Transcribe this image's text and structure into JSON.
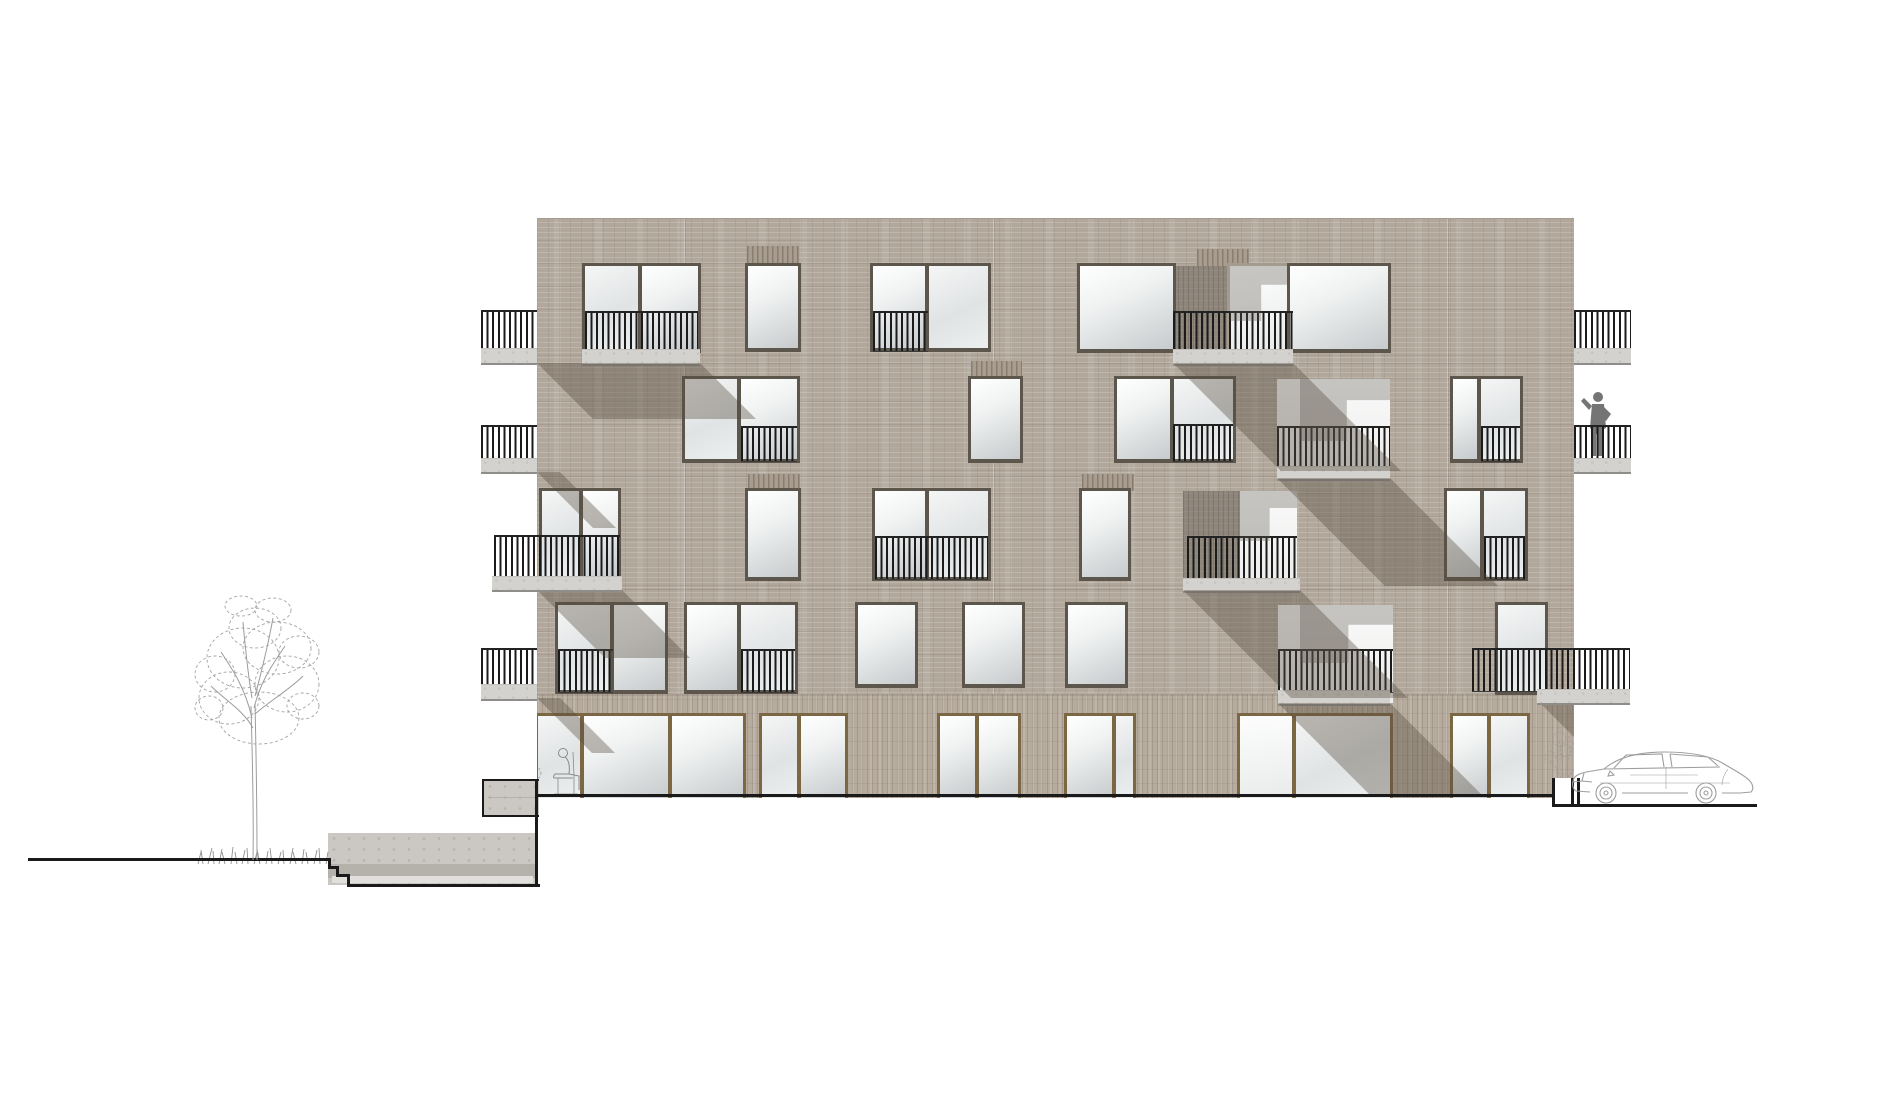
{
  "canvas": {
    "w": 1900,
    "h": 1116,
    "bg": "#ffffff"
  },
  "colors": {
    "brick": "#b1a79b",
    "brickGround": "#b6ab9d",
    "brickDark": "#8e857b",
    "concrete": "#d4d2ce",
    "railing": "#1b1b1b",
    "frameDark": "#5d564d",
    "frameBrown": "#7c6745",
    "shadow": "rgba(86,76,64,0.38)",
    "cut": "#1a1a1a",
    "sketch": "#9c9c9c",
    "figure": "#757575"
  },
  "building": {
    "x": 537,
    "y": 218,
    "w": 1037,
    "h": 579,
    "groundBandY": 693,
    "groundBandH": 104
  },
  "floorLines": [
    362,
    475,
    588
  ],
  "joints": [
    684,
    993,
    1447
  ],
  "levels": {
    "l5": {
      "y": 265,
      "h": 83
    },
    "l4": {
      "y": 378,
      "h": 80
    },
    "l3": {
      "y": 490,
      "h": 86
    },
    "l2": {
      "y": 604,
      "h": 85
    },
    "l1": {
      "y": 715,
      "h": 82
    }
  },
  "windows": [
    {
      "x": 585,
      "y": 265,
      "w": 113,
      "h": 83,
      "f": "d",
      "panes": [
        [
          0,
          53,
          "g2"
        ],
        [
          57,
          56,
          "g1"
        ]
      ]
    },
    {
      "x": 748,
      "y": 265,
      "w": 50,
      "h": 82,
      "f": "d",
      "panes": [
        [
          0,
          50,
          "g1"
        ]
      ]
    },
    {
      "x": 873,
      "y": 265,
      "w": 115,
      "h": 82,
      "f": "d",
      "panes": [
        [
          0,
          52,
          "g1"
        ],
        [
          56,
          59,
          "g2"
        ]
      ]
    },
    {
      "x": 1080,
      "y": 265,
      "w": 93,
      "h": 83,
      "f": "d",
      "panes": [
        [
          0,
          93,
          "g1"
        ]
      ]
    },
    {
      "x": 1230,
      "y": 265,
      "w": 60,
      "h": 83,
      "f": "l",
      "panes": [
        [
          0,
          60,
          "g3"
        ]
      ]
    },
    {
      "x": 1290,
      "y": 265,
      "w": 98,
      "h": 83,
      "f": "d",
      "panes": [
        [
          0,
          98,
          "g1"
        ]
      ]
    },
    {
      "x": 685,
      "y": 378,
      "w": 112,
      "h": 80,
      "f": "d",
      "panes": [
        [
          0,
          52,
          "g2"
        ],
        [
          56,
          56,
          "g1"
        ]
      ]
    },
    {
      "x": 971,
      "y": 378,
      "w": 49,
      "h": 80,
      "f": "d",
      "panes": [
        [
          0,
          49,
          "g1"
        ]
      ]
    },
    {
      "x": 1117,
      "y": 378,
      "w": 116,
      "h": 80,
      "f": "d",
      "panes": [
        [
          0,
          53,
          "g1"
        ],
        [
          57,
          59,
          "g2"
        ]
      ]
    },
    {
      "x": 1453,
      "y": 378,
      "w": 67,
      "h": 80,
      "f": "d",
      "panes": [
        [
          0,
          24,
          "g1"
        ],
        [
          28,
          39,
          "g2"
        ]
      ]
    },
    {
      "x": 542,
      "y": 490,
      "w": 76,
      "h": 86,
      "f": "d",
      "panes": [
        [
          0,
          37,
          "g2"
        ],
        [
          41,
          35,
          "g1"
        ]
      ]
    },
    {
      "x": 748,
      "y": 490,
      "w": 50,
      "h": 86,
      "f": "d",
      "panes": [
        [
          0,
          50,
          "g1"
        ]
      ]
    },
    {
      "x": 875,
      "y": 490,
      "w": 113,
      "h": 86,
      "f": "d",
      "panes": [
        [
          0,
          50,
          "g1"
        ],
        [
          54,
          59,
          "g2"
        ]
      ]
    },
    {
      "x": 1082,
      "y": 490,
      "w": 46,
      "h": 86,
      "f": "d",
      "panes": [
        [
          0,
          46,
          "g1"
        ]
      ]
    },
    {
      "x": 1447,
      "y": 490,
      "w": 78,
      "h": 86,
      "f": "d",
      "panes": [
        [
          0,
          33,
          "g1"
        ],
        [
          37,
          41,
          "g2"
        ]
      ]
    },
    {
      "x": 558,
      "y": 604,
      "w": 107,
      "h": 85,
      "f": "d",
      "panes": [
        [
          0,
          52,
          "g2"
        ],
        [
          56,
          51,
          "g1"
        ]
      ]
    },
    {
      "x": 687,
      "y": 604,
      "w": 108,
      "h": 85,
      "f": "d",
      "panes": [
        [
          0,
          50,
          "g1"
        ],
        [
          54,
          54,
          "g2"
        ]
      ]
    },
    {
      "x": 858,
      "y": 604,
      "w": 57,
      "h": 79,
      "f": "d",
      "panes": [
        [
          0,
          57,
          "g1"
        ]
      ]
    },
    {
      "x": 965,
      "y": 604,
      "w": 57,
      "h": 79,
      "f": "d",
      "panes": [
        [
          0,
          57,
          "g1"
        ]
      ]
    },
    {
      "x": 1068,
      "y": 604,
      "w": 57,
      "h": 79,
      "f": "d",
      "panes": [
        [
          0,
          57,
          "g1"
        ]
      ]
    },
    {
      "x": 1498,
      "y": 604,
      "w": 47,
      "h": 86,
      "f": "d",
      "panes": [
        [
          0,
          47,
          "g2"
        ]
      ]
    },
    {
      "x": 538,
      "y": 715,
      "w": 205,
      "h": 82,
      "f": "b",
      "panes": [
        [
          0,
          42,
          "g2"
        ],
        [
          46,
          84,
          "g1"
        ],
        [
          134,
          71,
          "g1"
        ]
      ]
    },
    {
      "x": 762,
      "y": 715,
      "w": 83,
      "h": 82,
      "f": "b",
      "panes": [
        [
          0,
          35,
          "g2"
        ],
        [
          39,
          44,
          "g1"
        ]
      ]
    },
    {
      "x": 940,
      "y": 715,
      "w": 78,
      "h": 82,
      "f": "b",
      "panes": [
        [
          0,
          35,
          "g1"
        ],
        [
          39,
          39,
          "g1"
        ]
      ]
    },
    {
      "x": 1067,
      "y": 715,
      "w": 66,
      "h": 82,
      "f": "b",
      "panes": [
        [
          0,
          45,
          "g1"
        ],
        [
          49,
          17,
          "g2"
        ]
      ]
    },
    {
      "x": 1240,
      "y": 715,
      "w": 150,
      "h": 82,
      "f": "b",
      "panes": [
        [
          0,
          52,
          "g3"
        ],
        [
          56,
          94,
          "g2"
        ]
      ]
    },
    {
      "x": 1453,
      "y": 715,
      "w": 74,
      "h": 82,
      "f": "b",
      "panes": [
        [
          0,
          34,
          "g1"
        ],
        [
          38,
          36,
          "g2"
        ]
      ]
    }
  ],
  "loggiaBacks": [
    {
      "x": 1277,
      "y": 378,
      "w": 113,
      "h": 99
    },
    {
      "x": 1240,
      "y": 490,
      "w": 57,
      "h": 99
    },
    {
      "x": 1278,
      "y": 604,
      "w": 115,
      "h": 98
    }
  ],
  "recesses": [
    {
      "x": 1173,
      "y": 265,
      "w": 57,
      "h": 83
    },
    {
      "x": 1183,
      "y": 490,
      "w": 57,
      "h": 87
    }
  ],
  "lintels": [
    {
      "x": 747,
      "y": 245,
      "w": 52,
      "h": 20
    },
    {
      "x": 1197,
      "y": 248,
      "w": 52,
      "h": 17
    },
    {
      "x": 971,
      "y": 360,
      "w": 51,
      "h": 18
    },
    {
      "x": 748,
      "y": 473,
      "w": 52,
      "h": 17
    },
    {
      "x": 1082,
      "y": 473,
      "w": 52,
      "h": 17
    }
  ],
  "balustrades": [
    {
      "x": 585,
      "y": 310,
      "w": 113,
      "h": 38
    },
    {
      "x": 873,
      "y": 310,
      "w": 55,
      "h": 38
    },
    {
      "x": 1173,
      "y": 310,
      "w": 120,
      "h": 38
    },
    {
      "x": 741,
      "y": 425,
      "w": 56,
      "h": 33
    },
    {
      "x": 1173,
      "y": 423,
      "w": 60,
      "h": 35
    },
    {
      "x": 1277,
      "y": 425,
      "w": 113,
      "h": 40
    },
    {
      "x": 1481,
      "y": 425,
      "w": 39,
      "h": 33
    },
    {
      "x": 875,
      "y": 535,
      "w": 113,
      "h": 41
    },
    {
      "x": 1187,
      "y": 535,
      "w": 110,
      "h": 42
    },
    {
      "x": 1484,
      "y": 535,
      "w": 41,
      "h": 41
    },
    {
      "x": 558,
      "y": 648,
      "w": 55,
      "h": 41
    },
    {
      "x": 741,
      "y": 648,
      "w": 54,
      "h": 41
    },
    {
      "x": 1278,
      "y": 648,
      "w": 115,
      "h": 41
    }
  ],
  "innerSlabs": [
    {
      "x": 582,
      "y": 348,
      "w": 118,
      "h": 14
    },
    {
      "x": 1173,
      "y": 348,
      "w": 120,
      "h": 14
    },
    {
      "x": 1277,
      "y": 465,
      "w": 113,
      "h": 12
    },
    {
      "x": 1183,
      "y": 577,
      "w": 117,
      "h": 12
    },
    {
      "x": 1278,
      "y": 689,
      "w": 112,
      "h": 13
    }
  ],
  "innerShadows": [
    {
      "x": 1230,
      "y": 265,
      "w": 60,
      "h": 55
    },
    {
      "x": 1300,
      "y": 378,
      "w": 90,
      "h": 62
    },
    {
      "x": 1240,
      "y": 490,
      "w": 57,
      "h": 50
    },
    {
      "x": 1300,
      "y": 604,
      "w": 93,
      "h": 58
    }
  ],
  "castShadows": [
    {
      "x": 537,
      "y": 362,
      "tw": 163,
      "h": 56
    },
    {
      "x": 537,
      "y": 471,
      "tw": 23,
      "h": 56
    },
    {
      "x": 537,
      "y": 589,
      "tw": 85,
      "h": 68
    },
    {
      "x": 537,
      "y": 697,
      "tw": 23,
      "h": 55
    },
    {
      "x": 1173,
      "y": 362,
      "tw": 120,
      "h": 108
    },
    {
      "x": 1277,
      "y": 477,
      "tw": 113,
      "h": 108
    },
    {
      "x": 1183,
      "y": 589,
      "tw": 117,
      "h": 108
    },
    {
      "x": 1278,
      "y": 702,
      "tw": 112,
      "h": 93
    },
    {
      "x": 1540,
      "y": 702,
      "tw": 34,
      "h": 60
    }
  ],
  "extBalconies": [
    {
      "x": 481,
      "y": 310,
      "w": 56,
      "rh": 38,
      "sh": 14
    },
    {
      "x": 481,
      "y": 425,
      "w": 56,
      "rh": 33,
      "sh": 13
    },
    {
      "x": 481,
      "y": 648,
      "w": 56,
      "rh": 36,
      "sh": 14
    },
    {
      "x": 494,
      "y": 535,
      "w": 126,
      "rh": 41,
      "sh": 13,
      "slabX": 492,
      "slabW": 130
    },
    {
      "x": 1574,
      "y": 310,
      "w": 57,
      "rh": 38,
      "sh": 14
    },
    {
      "x": 1574,
      "y": 425,
      "w": 57,
      "rh": 33,
      "sh": 13
    },
    {
      "x": 1472,
      "y": 648,
      "w": 158,
      "rh": 41,
      "sh": 13,
      "slabX": 1537,
      "slabW": 93
    }
  ],
  "ground": {
    "leftLine": {
      "x": 28,
      "y": 858,
      "w": 300,
      "t": 3
    },
    "steps": [
      {
        "x": 328,
        "y": 858,
        "w": 3,
        "h": 11
      },
      {
        "x": 328,
        "y": 866,
        "w": 11,
        "h": 3
      },
      {
        "x": 336,
        "y": 866,
        "w": 3,
        "h": 11
      },
      {
        "x": 336,
        "y": 874,
        "w": 14,
        "h": 3
      },
      {
        "x": 347,
        "y": 874,
        "w": 3,
        "h": 13
      }
    ],
    "wall": {
      "x": 328,
      "y": 833,
      "w": 209,
      "h": 52
    },
    "wallBand": {
      "x": 328,
      "y": 864,
      "w": 209,
      "h": 14
    },
    "wallLight": {
      "x": 332,
      "y": 876,
      "w": 201,
      "h": 7
    },
    "wallBottom": {
      "x": 347,
      "y": 884,
      "w": 193,
      "h": 3
    },
    "wallRightV": {
      "x": 535,
      "y": 779,
      "w": 3,
      "h": 108
    },
    "cornerSlab": {
      "x": 482,
      "y": 779,
      "w": 55,
      "h": 34
    },
    "baseLine": {
      "x": 537,
      "y": 794,
      "w": 1015,
      "t": 3
    },
    "well": {
      "x": 1552,
      "y": 778,
      "w": 22,
      "h": 26
    },
    "rightStepV": {
      "x": 1571,
      "y": 778,
      "w": 3,
      "h": 29
    },
    "rightLine": {
      "x": 1571,
      "y": 804,
      "w": 186,
      "t": 3
    }
  },
  "entourage": {
    "tree": {
      "x": 185,
      "y": 588,
      "w": 145,
      "h": 278
    },
    "grass": {
      "x": 195,
      "y": 838,
      "w": 135,
      "h": 26
    },
    "car": {
      "x": 1570,
      "y": 745,
      "w": 190,
      "h": 64
    },
    "personBalcony": {
      "x": 1576,
      "y": 390,
      "w": 40,
      "h": 70
    },
    "personSitting": {
      "x": 545,
      "y": 743,
      "w": 40,
      "h": 54
    },
    "shrubLeft": {
      "x": 490,
      "y": 740,
      "w": 52,
      "h": 60
    },
    "vineRight": {
      "x": 1538,
      "y": 726,
      "w": 40,
      "h": 74
    }
  }
}
